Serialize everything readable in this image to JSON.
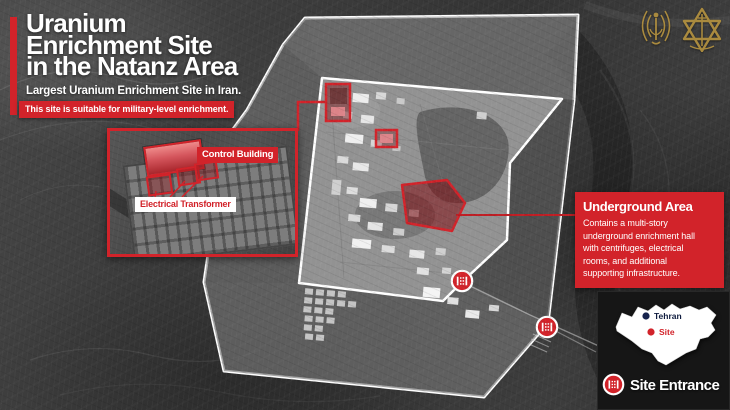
{
  "header": {
    "title_lines": [
      "Uranium",
      "Enrichment Site",
      "in the Natanz Area"
    ],
    "subtitle": "Largest Uranium Enrichment Site in Iran.",
    "banner": "This site is suitable for military-level enrichment."
  },
  "emblems": {
    "left_icon": "intelligence-corps-emblem",
    "right_icon": "idf-emblem"
  },
  "inset": {
    "control_building_label": "Control Building",
    "electrical_transformer_label": "Electrical Transformer"
  },
  "callout": {
    "title": "Underground Area",
    "body_lines": [
      "Contains a multi-story",
      "underground enrichment hall",
      "with centrifuges, electrical",
      "rooms, and additional",
      "supporting infrastructure."
    ]
  },
  "map_markers": {
    "entrance_icon": "gate-icon"
  },
  "legend": {
    "tehran_label": "Tehran",
    "site_label": "Site",
    "site_entrance_label": "Site Entrance"
  },
  "colors": {
    "accent_red": "#d2232a",
    "dark_red_fill": "#7a0c10",
    "gold": "#b3913f",
    "navy": "#16234d",
    "panel_dark": "#161616",
    "boundary_white": "#ffffff"
  }
}
